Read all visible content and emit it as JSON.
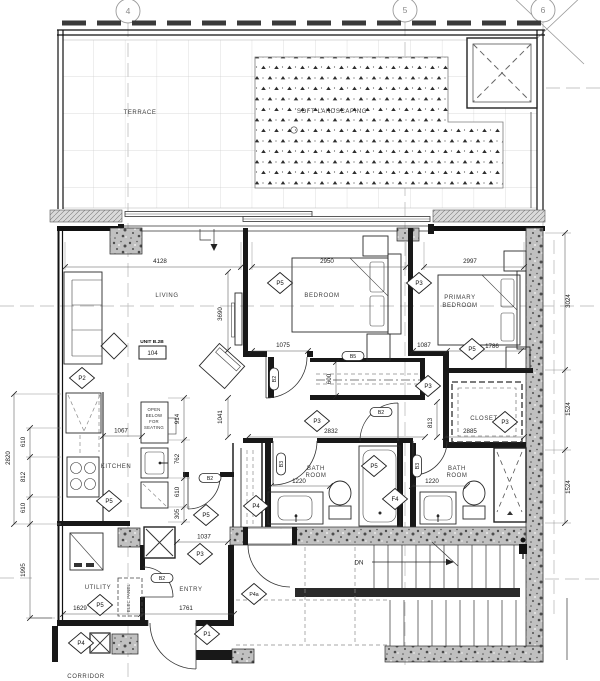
{
  "drawing": {
    "grid_bubbles": [
      "4",
      "5",
      "6"
    ],
    "labels": {
      "terrace": "TERRACE",
      "soft_landscaping": "SOFT LANDSCAPING",
      "living": "LIVING",
      "bedroom": "BEDROOM",
      "primary_line1": "PRIMARY",
      "primary_line2": "BEDROOM",
      "closet": "CLOSET",
      "kitchen": "KITCHEN",
      "bath_line1": "BATH",
      "bath_line2": "ROOM",
      "utility": "UTILITY",
      "entry": "ENTRY",
      "corridor": "CORRIDOR",
      "elec_panel": "ELEC PANEL",
      "open_l1": "OPEN",
      "open_l2": "BELOW",
      "open_l3": "FOR",
      "open_l4": "SEATING",
      "down": "DN"
    },
    "unit": {
      "name": "UNIT B.2B",
      "number": "104"
    },
    "dims": {
      "living_w": "4128",
      "living_h": "3690",
      "bedroom_w": "2950",
      "primary_w": "2997",
      "right_top": "3024",
      "right_mid": "1524",
      "right_bottom": "1524",
      "left_total": "2820",
      "left_a": "610",
      "left_b": "812",
      "left_c": "610",
      "left_lower": "1995",
      "kitchen_clear": "1067",
      "island_a": "914",
      "island_b": "762",
      "island_c": "610",
      "island_d": "305",
      "hall_left": "1041",
      "bed_door_l": "1075",
      "bed_door_r": "1087",
      "primary_door": "1786",
      "hall_w": "2832",
      "closet_w": "2885",
      "vestibule": "813",
      "bath1_w": "1220",
      "bath2_w": "1220",
      "wardrobe_d": "600",
      "entry_a": "1629",
      "entry_b": "1761",
      "entry_c": "1037"
    },
    "tags": {
      "p1": "P1",
      "p2": "P2",
      "p3": "P3",
      "p4": "P4",
      "p4a": "P4a",
      "p5": "P5",
      "f4": "F4",
      "b2": "B2",
      "b3": "B3",
      "b5": "B5"
    }
  }
}
